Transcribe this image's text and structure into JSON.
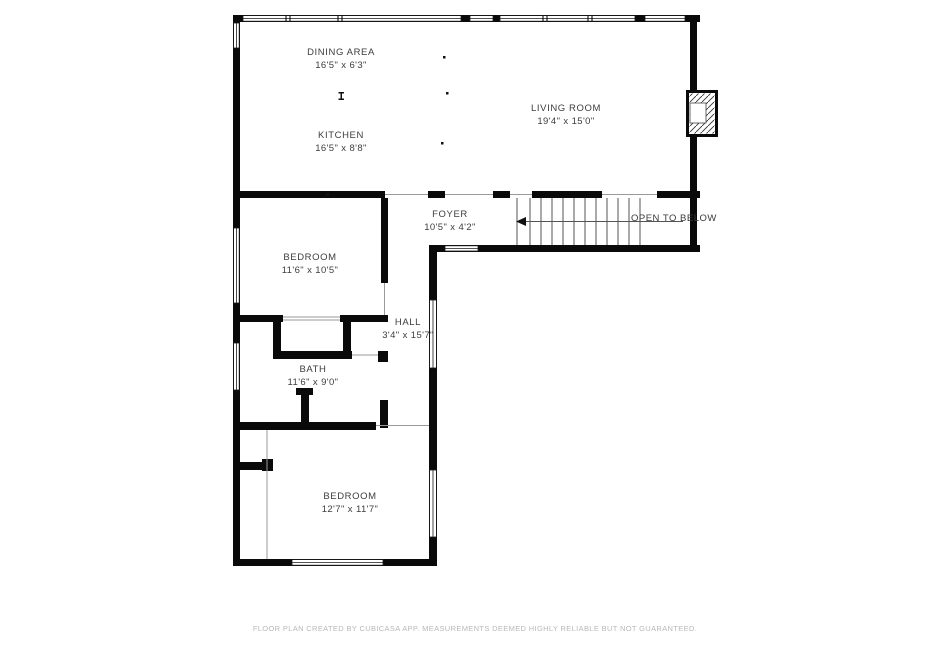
{
  "floor_plan": {
    "rooms": [
      {
        "id": "dining-area",
        "name": "DINING AREA",
        "dims": "16'5\" x 6'3\""
      },
      {
        "id": "kitchen",
        "name": "KITCHEN",
        "dims": "16'5\" x 8'8\""
      },
      {
        "id": "living-room",
        "name": "LIVING ROOM",
        "dims": "19'4\" x 15'0\""
      },
      {
        "id": "foyer",
        "name": "FOYER",
        "dims": "10'5\" x 4'2\""
      },
      {
        "id": "bedroom-1",
        "name": "BEDROOM",
        "dims": "11'6\" x 10'5\""
      },
      {
        "id": "hall",
        "name": "HALL",
        "dims": "3'4\" x 15'7\""
      },
      {
        "id": "bath",
        "name": "BATH",
        "dims": "11'6\" x 9'0\""
      },
      {
        "id": "bedroom-2",
        "name": "BEDROOM",
        "dims": "12'7\" x 11'7\""
      }
    ],
    "annotations": {
      "open_to_below": "OPEN TO BELOW"
    },
    "footer": "FLOOR PLAN CREATED BY CUBICASA APP. MEASUREMENTS DEEMED HIGHLY RELIABLE BUT NOT GUARANTEED.",
    "colors": {
      "wall": "#0a0a0a",
      "label": "#3d3d3d",
      "footer_text": "#b8b8b8",
      "background": "#ffffff"
    }
  }
}
